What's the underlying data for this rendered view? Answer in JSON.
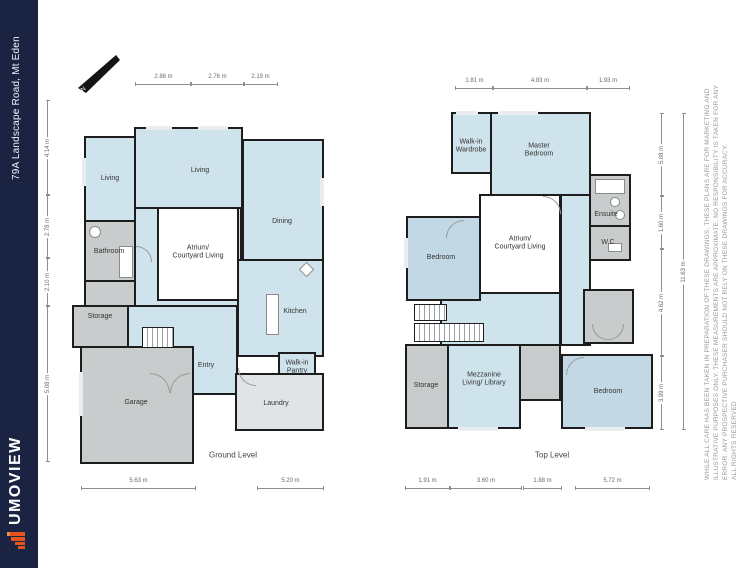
{
  "sidebar": {
    "address": "79A Landscape Road, Mt Eden",
    "brand": "UMOVIEW",
    "bg_color": "#1b2342",
    "accent_color": "#e6541d"
  },
  "disclaimer": {
    "lines": [
      "WHILE ALL CARE HAS BEEN TAKEN IN PREPARATION OF THESE DRAWINGS, THESE PLANS ARE FOR MARKETING AND",
      "ILLUSTRATIVE PURPOSES ONLY. THESE MEASUREMENTS ARE APPROXIMATE, NO RESPONSIBILITY IS TAKEN FOR ANY",
      "ERROR. ANY PROSPECTIVE PURCHASER SHOULD NOT RELY ON THESE DRAWINGS FOR ACCURACY.",
      "ALL RIGHTS RESERVED"
    ]
  },
  "compass": {
    "label": "N"
  },
  "colors": {
    "room_blue": "#cfe3ec",
    "room_blue_dark": "#c2d8e4",
    "room_gray": "#c9cccd",
    "room_light_gray": "#e0e4e7",
    "wall": "#1d1d1d"
  },
  "ground": {
    "title": "Ground Level",
    "rooms": {
      "living_small": "Living",
      "living": "Living",
      "dining": "Dining",
      "bathroom": "Bathroom",
      "storage": "Storage",
      "garage": "Garage",
      "entry": "Entry",
      "kitchen": "Kitchen",
      "pantry": "Walk-in\nPantry",
      "laundry": "Laundry",
      "atrium": "Atrium/\nCourtyard Living"
    },
    "dims": {
      "top": [
        "2.86 m",
        "2.76 m",
        "2.19 m"
      ],
      "left": [
        "4.14 m",
        "2.78 m",
        "2.10 m",
        "5.08 m"
      ],
      "bottom": [
        "5.63 m",
        "5.20 m"
      ]
    }
  },
  "top_level": {
    "title": "Top Level",
    "rooms": {
      "wardrobe": "Walk-in\nWardrobe",
      "master": "Master\nBedroom",
      "ensuite": "Ensuite",
      "wc": "W.C",
      "bedroom_left": "Bedroom",
      "atrium": "Atrium/\nCourtyard Living",
      "storage": "Storage",
      "mezzanine": "Mezzanine\nLiving/ Library",
      "bedroom_right": "Bedroom"
    },
    "dims": {
      "top": [
        "1.81 m",
        "4.83 m",
        "1.93 m"
      ],
      "bottom": [
        "1.91 m",
        "3.60 m",
        "1.88 m",
        "5.72 m"
      ],
      "right": [
        "5.08 m",
        "1.60 m",
        "4.62 m",
        "3.99 m"
      ],
      "right_total": "11.63 m"
    }
  }
}
